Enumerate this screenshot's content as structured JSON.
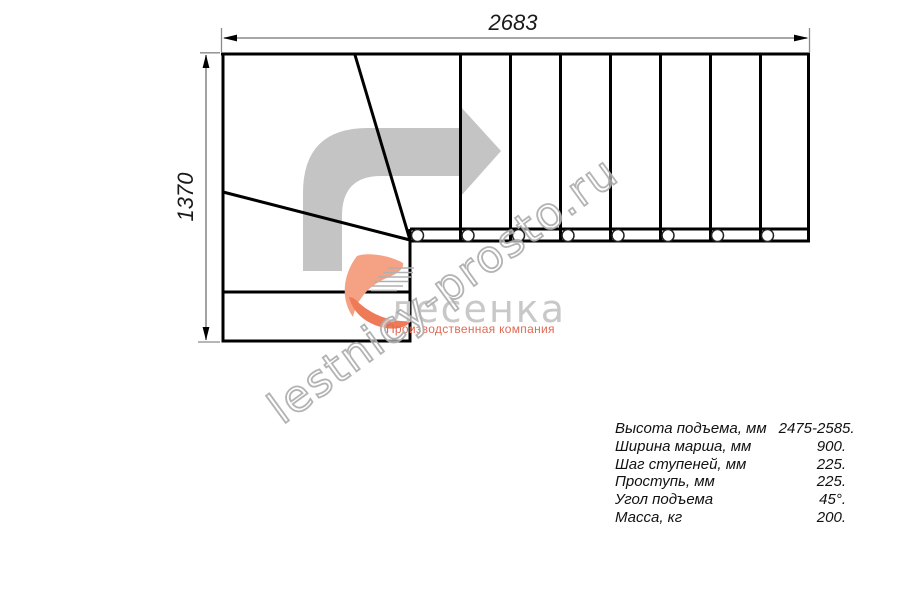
{
  "drawing": {
    "type": "stair-plan-top-view",
    "dimensions": {
      "width_label": "2683",
      "height_label": "1370"
    }
  },
  "specs": {
    "rows": [
      {
        "label": "Высота подъема, мм",
        "value": "2475-2585."
      },
      {
        "label": "Ширина марша, мм",
        "value": "900."
      },
      {
        "label": "Шаг ступеней, мм",
        "value": "225."
      },
      {
        "label": "Проступь, мм",
        "value": "225."
      },
      {
        "label": "Угол подъема",
        "value": "45°."
      },
      {
        "label": "Масса, кг",
        "value": "200."
      }
    ]
  },
  "watermark": {
    "text": "lestnicy-prosto.ru"
  },
  "logo": {
    "name": "лесенка",
    "tagline": "Производственная компания"
  },
  "icons": {
    "direction_arrow": "turn-right-arrow",
    "logo_mark": "stair-swoosh"
  },
  "colors": {
    "plan_line": "#000000",
    "dimension_line": "#8a8a8a",
    "dimension_text": "#1a1a1a",
    "direction_arrow": "#c4c4c4",
    "logo_salmon": "#f4a283",
    "logo_accent": "#ee7a58",
    "logo_text": "#c8c8c8",
    "tagline_text": "#e06a52",
    "watermark_stroke": "#ababab",
    "background": "#ffffff"
  }
}
